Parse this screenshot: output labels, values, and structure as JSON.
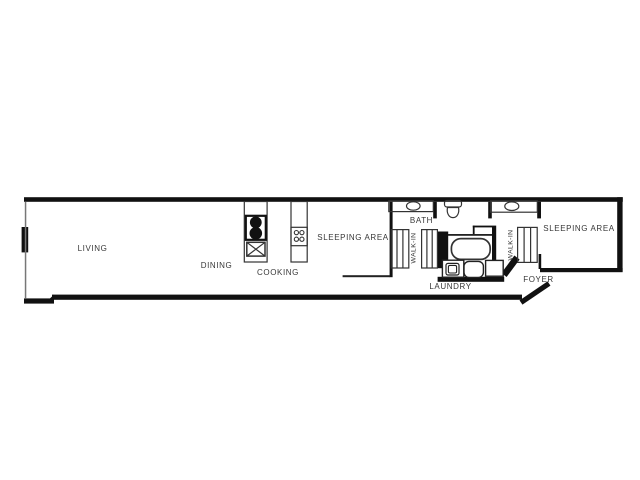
{
  "page": {
    "type": "apartment floor plan drawing",
    "background_color": "#ffffff"
  },
  "floorplan": {
    "labels": {
      "living": "LIVING",
      "dining": "DINING",
      "cooking": "COOKING",
      "sleeping_area_mid": "SLEEPING AREA",
      "bath": "BATH",
      "walk_in_left": "WALK-IN",
      "walk_in_right": "WALK-IN",
      "laundry": "LAUNDRY",
      "foyer": "FOYER",
      "sleeping_area_right": "SLEEPING AREA"
    },
    "fixtures": {
      "stove-icon": "box with two black burner circles",
      "kitchen-sink-icon": "square crossed with X",
      "cooktop-icon": "box with four small circles",
      "vanity-sink-left-icon": "counter with oval basin",
      "toilet-icon": "tank and bowl",
      "vanity-sink-right-icon": "counter with oval basin",
      "bathtub-icon": "rounded rectangle tub",
      "washer-icon": "square with nested rounded square",
      "laundry-tub-icon": "rounded rectangle",
      "dryer-icon": "plain square",
      "closet-rod-icon": "band of vertical lines"
    },
    "colors": {
      "wall": "#111111",
      "thin_wall": "#777777",
      "line": "#333333",
      "text": "#383838",
      "background": "#ffffff"
    }
  }
}
